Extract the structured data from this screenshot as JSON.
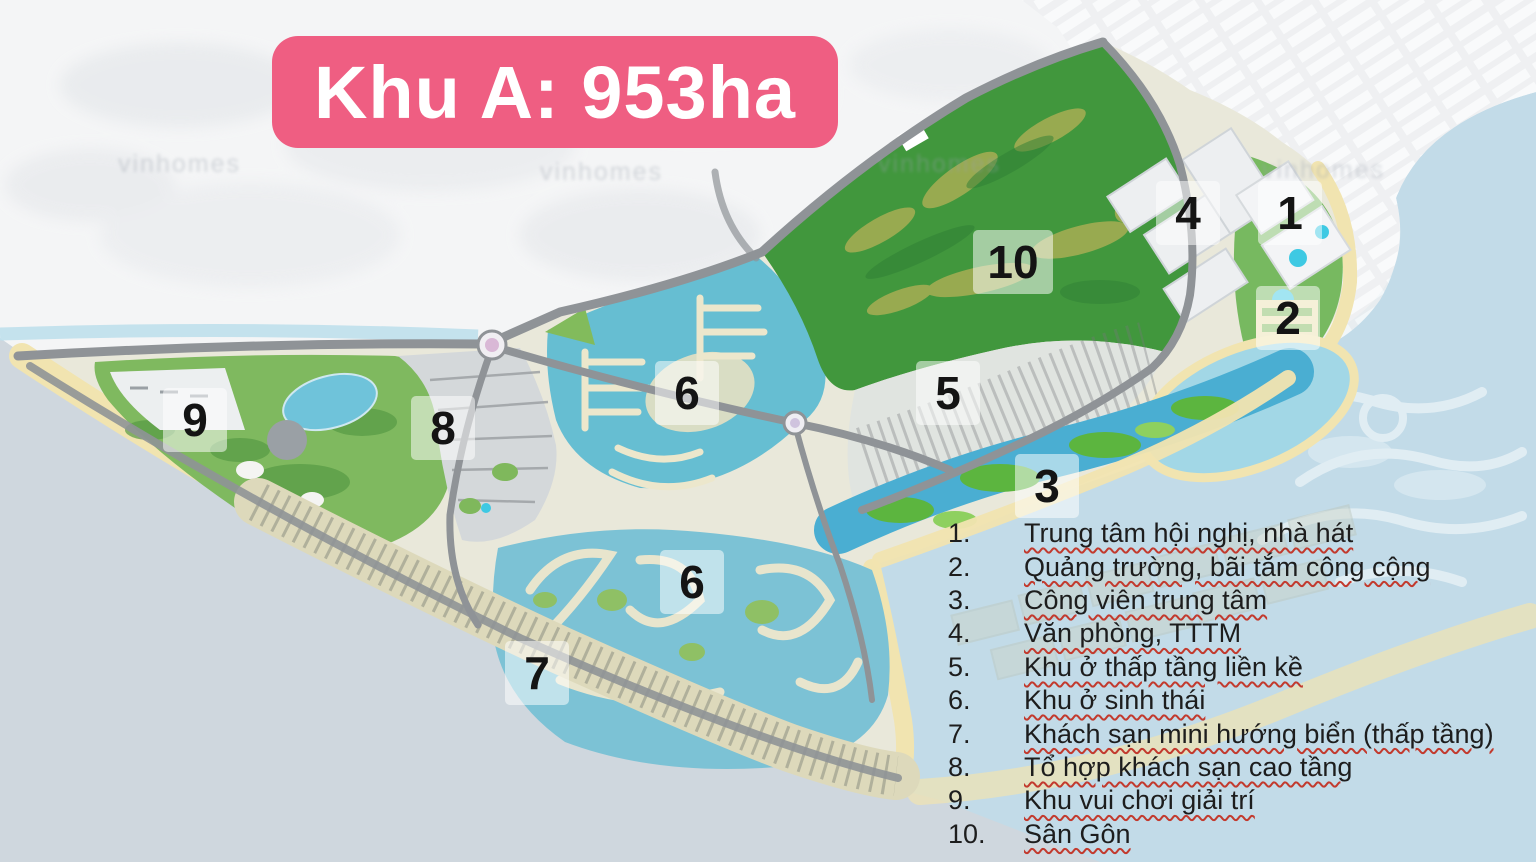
{
  "title": {
    "label": "Khu A: 953ha"
  },
  "map": {
    "markers": [
      {
        "label": "1"
      },
      {
        "label": "2"
      },
      {
        "label": "3"
      },
      {
        "label": "4"
      },
      {
        "label": "5"
      },
      {
        "label": "6"
      },
      {
        "label": "6"
      },
      {
        "label": "7"
      },
      {
        "label": "8"
      },
      {
        "label": "9"
      },
      {
        "label": "10"
      }
    ]
  },
  "legend": {
    "items": [
      {
        "num": "1.",
        "label": "Trung tâm hội nghị, nhà hát"
      },
      {
        "num": "2.",
        "label": "Quảng trường, bãi tắm công cộng"
      },
      {
        "num": "3.",
        "label": "Công viên trung tâm"
      },
      {
        "num": "4.",
        "label": "Văn phòng, TTTM"
      },
      {
        "num": "5.",
        "label": "Khu ở thấp tầng liền kề"
      },
      {
        "num": "6.",
        "label": "Khu ở sinh thái"
      },
      {
        "num": "7.",
        "label": "Khách sạn mini hướng biển (thấp tầng)"
      },
      {
        "num": "8.",
        "label": "Tổ hợp khách sạn cao tầng"
      },
      {
        "num": "9.",
        "label": "Khu vui chơi giải trí"
      },
      {
        "num": "10.",
        "label": "Sân Gôn"
      }
    ]
  },
  "watermark": {
    "text": "vinhomes"
  },
  "colors": {
    "badge_pink": "#ef5e82",
    "title_text": "#ffffff",
    "sea": "#c2dbe8",
    "sea_sw": "#cfd7de",
    "mainland": "#f4f5f6",
    "zonea_base": "#e9e8da",
    "sand": "#f1e4b0",
    "golf_green": "#41973d",
    "park_green": "#7fb95f",
    "marina_teal": "#66bed2",
    "canal_teal": "#7cc2d5",
    "lagoon_blue": "#a2d7e6",
    "waterway_blue": "#4aaed2",
    "road_gray": "#8f9397",
    "underline_red": "#c23a2e",
    "legend_text": "#1d1d1d",
    "marker_bg": "rgba(255,255,255,0.52)",
    "marker_text": "#141414"
  }
}
